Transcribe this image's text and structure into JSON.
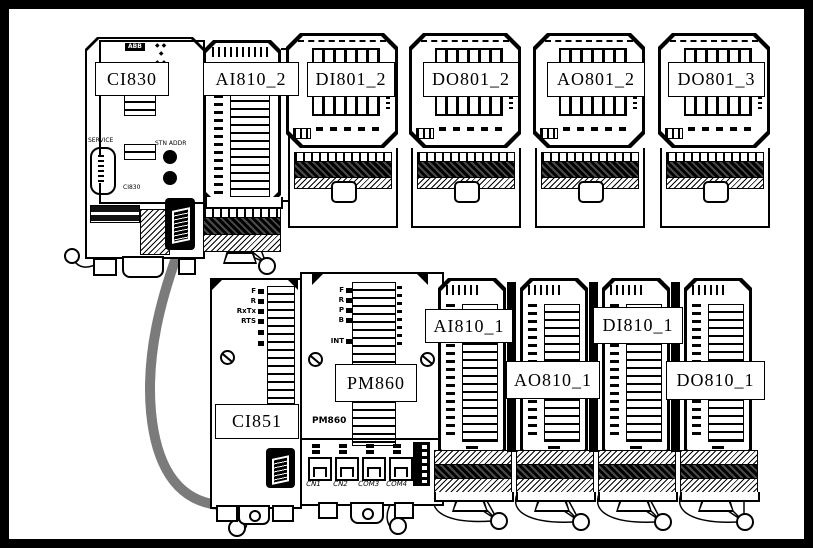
{
  "colors": {
    "line": "#000000",
    "background": "#ffffff",
    "cable": "#7b7b7b"
  },
  "modules": {
    "ci830": {
      "label": "CI830",
      "logo": "ABB",
      "service_label": "SERVICE",
      "stn_addr_label": "STN ADDR",
      "body_text": "CI830"
    },
    "ai810_2": {
      "label": "AI810_2"
    },
    "di801_2": {
      "label": "DI801_2"
    },
    "do801_2": {
      "label": "DO801_2"
    },
    "ao801_2": {
      "label": "AO801_2"
    },
    "do801_3": {
      "label": "DO801_3"
    },
    "ci851": {
      "label": "CI851",
      "leds": [
        "F",
        "R",
        "RxTx",
        "RTS"
      ]
    },
    "pm860": {
      "label": "PM860",
      "body_text": "PM860",
      "leds": [
        "F",
        "R",
        "P",
        "B"
      ],
      "int_label": "INT",
      "ports": [
        "CN1",
        "CN2",
        "COM3",
        "COM4"
      ]
    },
    "ai810_1": {
      "label": "AI810_1"
    },
    "ao810_1": {
      "label": "AO810_1"
    },
    "di810_1": {
      "label": "DI810_1"
    },
    "do810_1": {
      "label": "DO810_1"
    }
  }
}
